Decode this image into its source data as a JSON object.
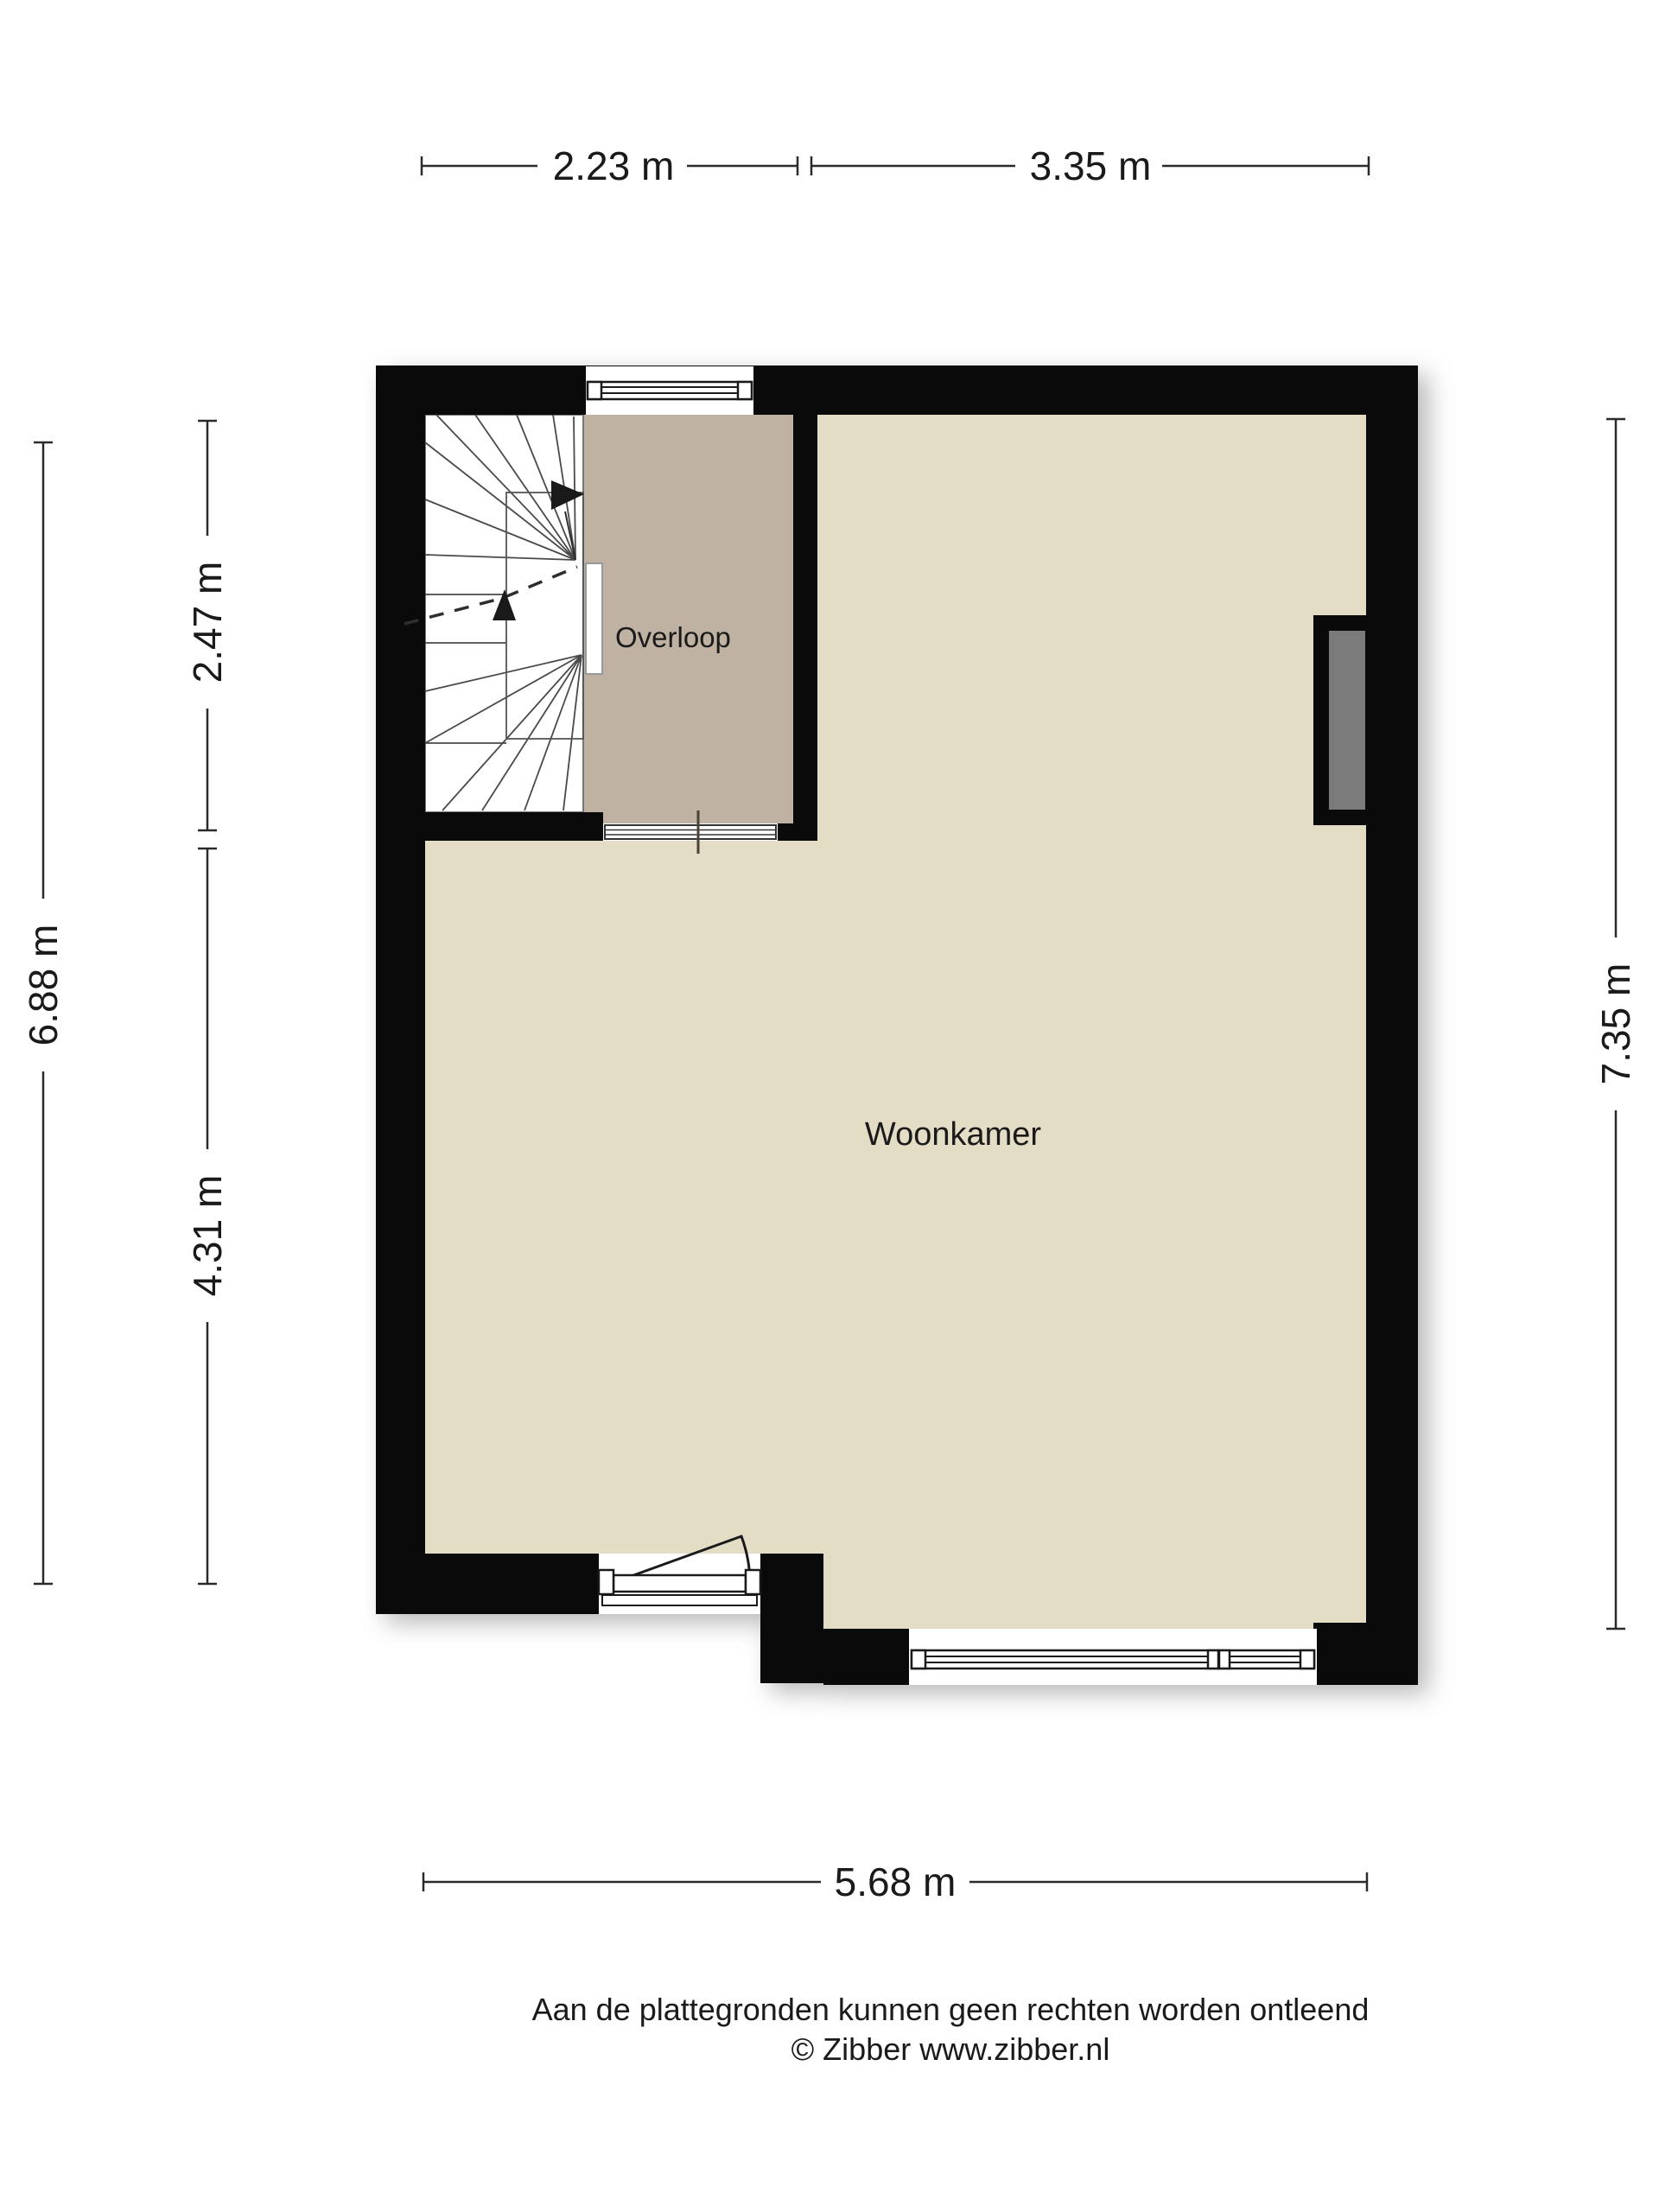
{
  "colors": {
    "wall": "#0a0a0a",
    "floor_living": "#e4ddc6",
    "floor_landing": "#c0b2a3",
    "niche": "#7b7b7b",
    "dim_line": "#2a2a2a",
    "stair_line": "#4a4a4a"
  },
  "rooms": {
    "landing": "Overloop",
    "living": "Woonkamer"
  },
  "dimensions": {
    "top_left": "2.23 m",
    "top_right": "3.35 m",
    "left_outer": "6.88 m",
    "left_upper": "2.47 m",
    "left_lower": "4.31 m",
    "right": "7.35 m",
    "bottom": "5.68 m"
  },
  "footer": {
    "disclaimer": "Aan de plattegronden kunnen geen rechten worden ontleend",
    "credit": "© Zibber www.zibber.nl"
  }
}
